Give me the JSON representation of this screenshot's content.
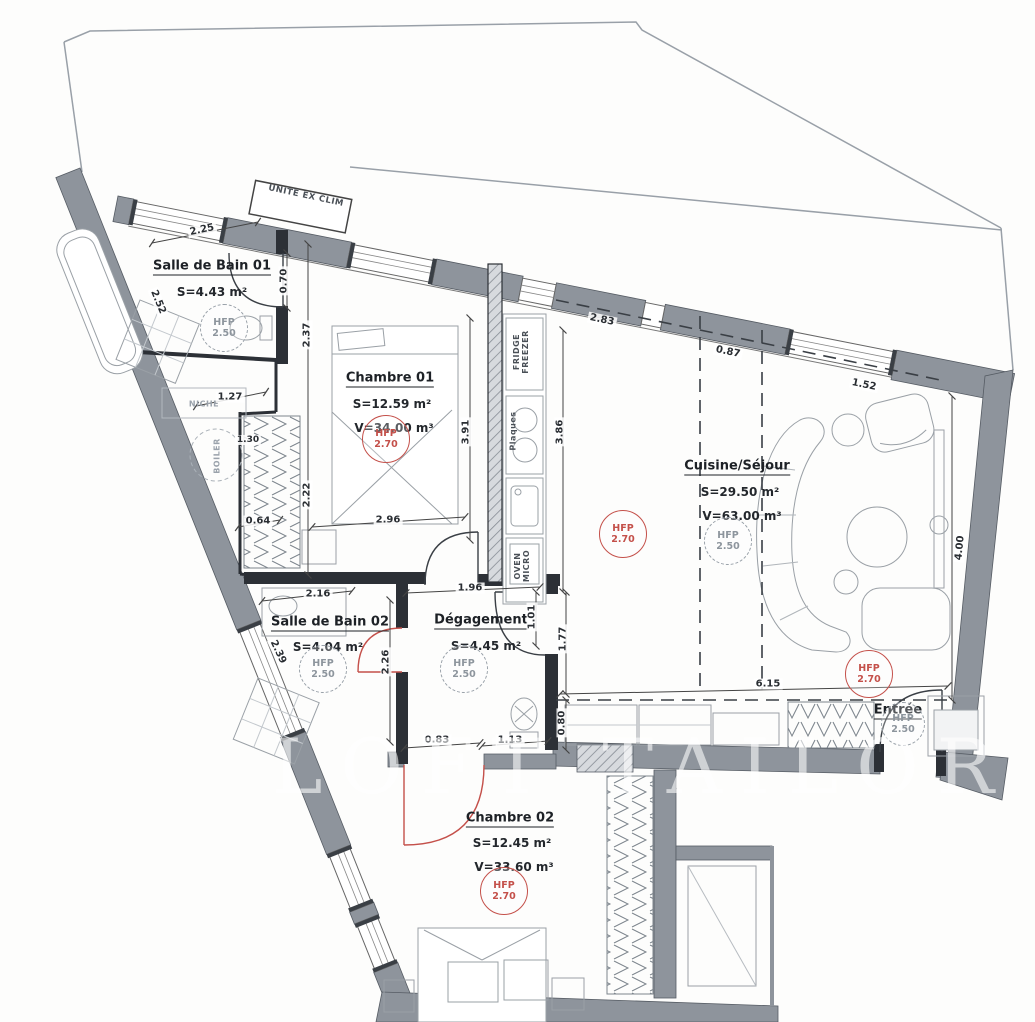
{
  "watermark": "LOFT TAILOR",
  "colors": {
    "wall_gray": "#8e949c",
    "hatch_fill": "#d7dade",
    "interior_wall": "#2c3036",
    "door_red": "#c4504a",
    "hfp_red": "#c4504a",
    "hfp_gray": "#8d959d",
    "line": "#444444"
  },
  "rooms": {
    "sdb1": {
      "name": "Salle de Bain 01",
      "area": "S=4.43 m²",
      "hfp_label": "HFP",
      "hfp_value": "2.50"
    },
    "chambre1": {
      "name": "Chambre 01",
      "area": "S=12.59 m²",
      "volume": "V=34.00 m³",
      "hfp_label": "HFP",
      "hfp_value": "2.70"
    },
    "cuisine": {
      "name": "Cuisine/Séjour",
      "area": "S=29.50 m²",
      "volume": "V=63.00 m³",
      "hfp_label": "HFP",
      "hfp_value": "2.50"
    },
    "sdb2": {
      "name": "Salle de Bain 02",
      "area": "S=4.04 m²",
      "hfp_label": "HFP",
      "hfp_value": "2.50"
    },
    "degagement": {
      "name": "Dégagement",
      "area": "S=4.45 m²",
      "hfp_label": "HFP",
      "hfp_value": "2.50"
    },
    "chambre2": {
      "name": "Chambre 02",
      "area": "S=12.45 m²",
      "volume": "V=33.60 m³",
      "hfp_label": "HFP",
      "hfp_value": "2.70"
    },
    "entree": {
      "name": "Entrée",
      "hfp_label": "HFP",
      "hfp_value": "2.50"
    }
  },
  "extra_hfp": {
    "sejour_mid": {
      "label": "HFP",
      "value": "2.70"
    },
    "sejour_right": {
      "label": "HFP",
      "value": "2.70"
    }
  },
  "equipment": {
    "unite_ex_clim": "UNITE EX CLIM",
    "fridge": "FRIDGE",
    "freezer": "FREEZER",
    "plaques": "Plaques",
    "oven": "OVEN",
    "micro": "MICRO",
    "niche": "NICHE",
    "boiler": "BOILER"
  },
  "dims": {
    "d225": "2.25",
    "d070": "0.70",
    "d237": "2.37",
    "d127": "1.27",
    "d252": "2.52",
    "d130": "1.30",
    "d222": "2.22",
    "d064": "0.64",
    "d296": "2.96",
    "d391": "3.91",
    "d386": "3.86",
    "d283": "2.83",
    "d087": "0.87",
    "d152": "1.52",
    "d400": "4.00",
    "d216": "2.16",
    "d196": "1.96",
    "d101": "1.01",
    "d177": "1.77",
    "d226": "2.26",
    "d239": "2.39",
    "d083": "0.83",
    "d113": "1.13",
    "d615": "6.15",
    "d080": "0.80"
  }
}
